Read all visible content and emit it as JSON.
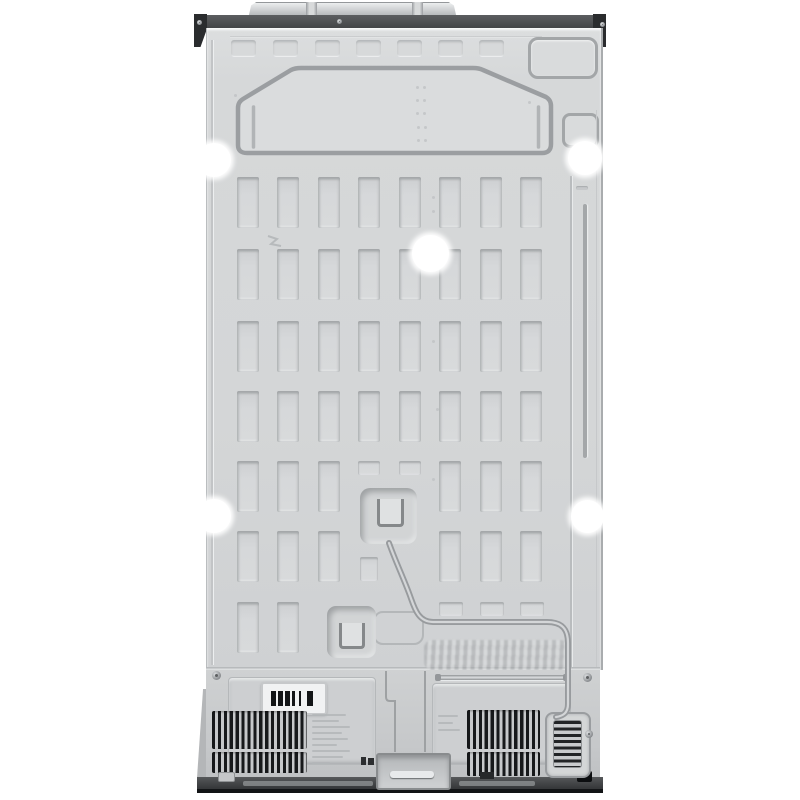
{
  "scene": {
    "description": "Product photograph of the rear side of a stainless side-by-side refrigerator on a white background",
    "background_color": "#ffffff"
  },
  "palette": {
    "bg": "#ffffff",
    "panel": "#d5d7d8",
    "panel-light": "#dddfe0",
    "panel-dark": "#cbcdcf",
    "line": "#9da0a2",
    "line-soft": "#b7babc",
    "hl": "#eef0f1",
    "top-bar": "#4e5052",
    "bracket": "#2a2c2e",
    "base": "#3f4143",
    "base-dark": "#121416",
    "bottom": "#c9cbcd",
    "vent": "#17191b",
    "grille": "#222426",
    "tube": "#989b9e",
    "label-bg": "#f1f2f3",
    "hole": "#ffffff"
  },
  "parts": {
    "photo": {
      "label": "rear view of refrigerator cabinet"
    },
    "top_hinge_cover": {
      "label": "top hinge and cord cover plate"
    },
    "top_trim": {
      "label": "dark top trim bar"
    },
    "corner_bracket_left": {
      "label": "top left corner bracket"
    },
    "corner_bracket_right": {
      "label": "top right corner bracket"
    },
    "back_panel": {
      "label": "stamped sheet-metal back panel"
    },
    "air_duct_emboss": {
      "label": "embossed air duct panel"
    },
    "access_outline": {
      "label": "embossed access panel outline"
    },
    "small_access": {
      "label": "small embossed access square"
    },
    "stiffener_slots": {
      "label": "embossed stiffener slot grid"
    },
    "mounting_holes": {
      "label": "white mounting holes"
    },
    "valve_box_upper": {
      "label": "embossed water valve recess with bracket"
    },
    "valve_box_lower": {
      "label": "lower embossed recess with bracket"
    },
    "refrigerant_tube": {
      "label": "refrigerant tube routed to bottom grille"
    },
    "stamped_serial": {
      "label": "stamped embossed characters"
    },
    "compressor_compartment": {
      "label": "bottom compressor compartment"
    },
    "serial_plate": {
      "label": "white plate with black vent marks"
    },
    "vent_left": {
      "label": "left black vent grille"
    },
    "vent_right": {
      "label": "right black vent grille"
    },
    "drain_grille": {
      "label": "bottom right drain grille"
    },
    "spec_label": {
      "label": "faint printed specification label"
    },
    "center_bracket": {
      "label": "center mounting bracket"
    },
    "base_trim": {
      "label": "dark base trim bar"
    }
  }
}
